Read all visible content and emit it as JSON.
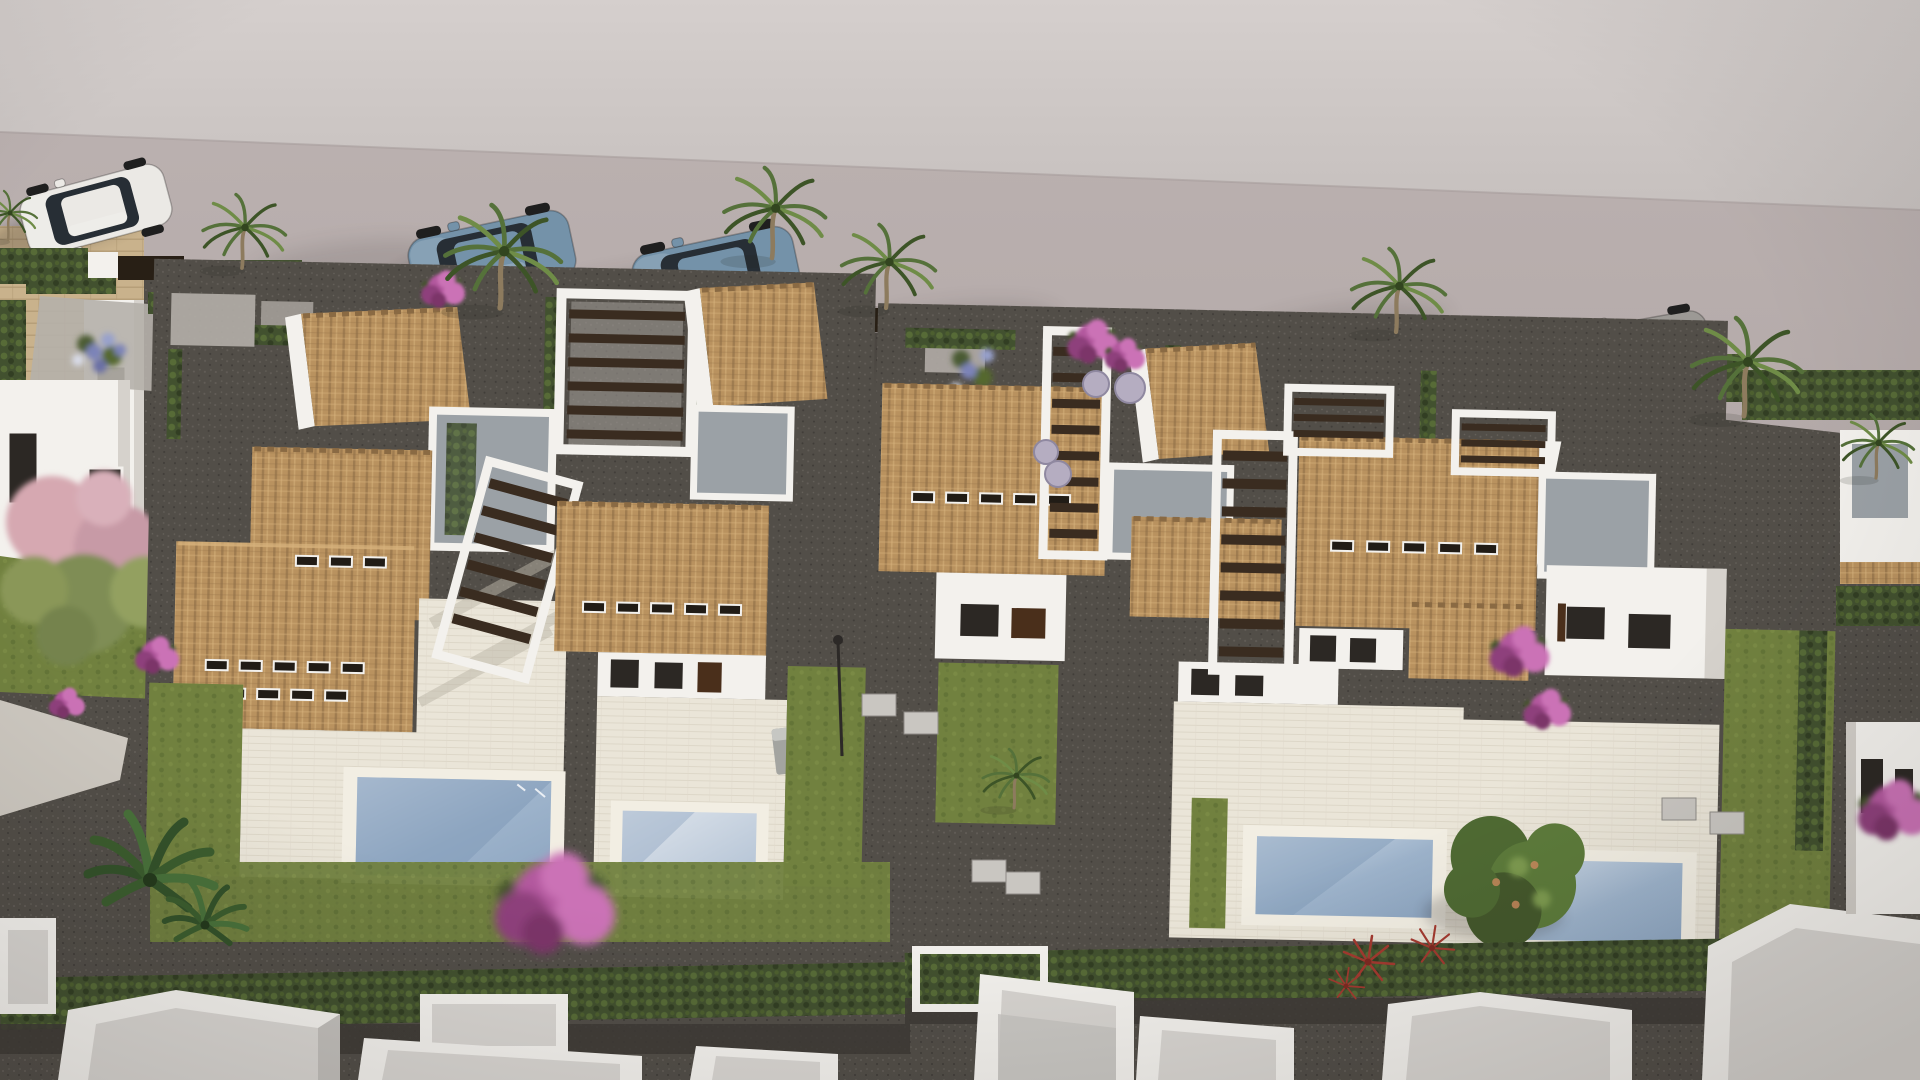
{
  "meta": {
    "kind": "3d-architectural-render",
    "view": "aerial-oblique",
    "subject": "Mediterranean villa development: two blocks of white villas with terracotta tile roofs, wood-slat pergolas, private pools and lawns, cars parked along a street above, row of unfinished white rooftops below",
    "lighting": {
      "sun_direction": "upper-right",
      "shadow_direction": "lower-left"
    }
  },
  "palette": {
    "sidewalk": "#cdc6c4",
    "sidewalk_top": "#d5cfcd",
    "road": "#b4aaa9",
    "road_dark": "#a49a99",
    "wall_white": "#f3f1ed",
    "wall_shade": "#d6d2cc",
    "roof_tile": "#b9925f",
    "roof_tile_dark": "#8a6a43",
    "roof_tile_light": "#d8b37d",
    "flat_roof": "#9ba1a6",
    "flat_roof_dark": "#84898e",
    "deck": "#eae5d8",
    "deck_shadow": "#bcb6a8",
    "pool_coping": "#f2eee3",
    "water_light": "#cdd8e5",
    "water": "#9db3cb",
    "water_dark": "#7e98b6",
    "lawn": "#71813f",
    "lawn_dark": "#5a6a32",
    "hedge": "#42512f",
    "hedge_light": "#5d7439",
    "gravel": "#524e48",
    "gravel_dark": "#3e3b36",
    "gravel_light": "#6b665f",
    "path_light": "#cdc8c0",
    "pergola_wood": "#3a2c20",
    "fence_brown": "#4a2f1b",
    "fence_dark": "#281f15",
    "car_blue": "#7492a9",
    "car_white": "#ebe9e5",
    "car_gray": "#9c9995",
    "palm_green": "#55713a",
    "palm_green_dark": "#3d5427",
    "palm_green_light": "#6f8c47",
    "palm_trunk": "#8d7b5e",
    "banana_green": "#33512a",
    "bougainvillea": "#b2589e",
    "bougainvillea_light": "#cb72b6",
    "bougainvillea_dark": "#8e3f7c",
    "blossom_pink": "#d6a8b1",
    "blossom_green": "#8a9758",
    "blue_flowers": "#7b83b8",
    "silver_bush": "#b5adc1",
    "yellow_flowers": "#c6bd5c",
    "red_plant": "#a43a30",
    "stone_wall": "#c9b28c",
    "stone_line": "#b29a74",
    "window_dark": "#2c2824",
    "shadow": "#241f1c"
  },
  "street": {
    "surface": "light pink-gray asphalt",
    "sidewalk_edge": [
      [
        0,
        132
      ],
      [
        1920,
        210
      ]
    ],
    "cars": [
      {
        "name": "white-hatchback",
        "color": "car_white",
        "x": 96,
        "y": 210,
        "rotate": 165,
        "scale": 0.95
      },
      {
        "name": "blue-suv-a",
        "color": "car_blue",
        "x": 492,
        "y": 258,
        "rotate": 168,
        "scale": 1.05
      },
      {
        "name": "blue-suv-b",
        "color": "car_blue",
        "x": 716,
        "y": 274,
        "rotate": 168,
        "scale": 1.05
      },
      {
        "name": "gray-sedan",
        "color": "car_gray",
        "x": 1636,
        "y": 352,
        "rotate": 170,
        "scale": 0.95
      }
    ]
  },
  "blocks": [
    {
      "name": "left-villa-block",
      "villas": 2,
      "pools": [
        {
          "x": 362,
          "y": 780,
          "w": 194,
          "h": 98
        },
        {
          "x": 628,
          "y": 808,
          "w": 134,
          "h": 78
        }
      ],
      "features": [
        "terracotta-hip-roofs",
        "roof-vent-slots",
        "white-pergolas-with-dark-wood-slats",
        "gray-flat-roof-terraces",
        "cream-deck-terraces",
        "private-lawns",
        "sun-lounger"
      ]
    },
    {
      "name": "right-villa-block",
      "villas": 2,
      "pools": [
        {
          "x": 1262,
          "y": 837,
          "w": 176,
          "h": 78
        },
        {
          "x": 1516,
          "y": 855,
          "w": 172,
          "h": 80
        }
      ],
      "features": [
        "terracotta-hip-roofs",
        "roof-vent-slots",
        "long-slatted-pergola-walkways",
        "gray-flat-roof-terraces",
        "cream-deck-terraces",
        "garden-tree-over-pool",
        "red-accent-plants"
      ]
    }
  ],
  "construction_row": {
    "count": 8,
    "description": "unfinished white parapet rooftops along the bottom edge"
  },
  "neighbor_left": {
    "description": "existing house with travertine stone walls, white facade, dark windows, courtyard with blue flowers and pink flowering tree"
  },
  "vegetation": {
    "palms": [
      {
        "x": 242,
        "y": 268,
        "s": 0.75
      },
      {
        "x": 500,
        "y": 308,
        "s": 1.05
      },
      {
        "x": 772,
        "y": 258,
        "s": 0.92
      },
      {
        "x": 886,
        "y": 308,
        "s": 0.85
      },
      {
        "x": 1396,
        "y": 332,
        "s": 0.85
      },
      {
        "x": 1744,
        "y": 416,
        "s": 1.0
      },
      {
        "x": 1876,
        "y": 478,
        "s": 0.65
      },
      {
        "x": 1014,
        "y": 808,
        "s": 0.6
      },
      {
        "x": 8,
        "y": 240,
        "s": 0.5
      }
    ],
    "bananas": [
      {
        "x": 150,
        "y": 880,
        "s": 1.0
      },
      {
        "x": 205,
        "y": 925,
        "s": 0.65
      }
    ],
    "bougainvillea": [
      {
        "x": 442,
        "y": 288,
        "s": 0.55
      },
      {
        "x": 1092,
        "y": 340,
        "s": 0.65
      },
      {
        "x": 1124,
        "y": 354,
        "s": 0.5
      },
      {
        "x": 552,
        "y": 900,
        "s": 1.5
      },
      {
        "x": 156,
        "y": 654,
        "s": 0.55
      },
      {
        "x": 66,
        "y": 702,
        "s": 0.45
      },
      {
        "x": 1518,
        "y": 650,
        "s": 0.75
      },
      {
        "x": 1546,
        "y": 708,
        "s": 0.6
      },
      {
        "x": 1892,
        "y": 808,
        "s": 0.9
      }
    ],
    "red_plants": [
      {
        "x": 1368,
        "y": 962,
        "s": 1.0
      },
      {
        "x": 1432,
        "y": 948,
        "s": 0.85
      },
      {
        "x": 1346,
        "y": 986,
        "s": 0.7
      }
    ],
    "silver_bushes": [
      {
        "x": 1096,
        "y": 384,
        "r": 13
      },
      {
        "x": 1130,
        "y": 388,
        "r": 15
      },
      {
        "x": 1046,
        "y": 452,
        "r": 12
      },
      {
        "x": 1058,
        "y": 474,
        "r": 13
      }
    ],
    "garden_tree": {
      "x": 1522,
      "y": 876
    }
  },
  "utilities": {
    "boxes": [
      {
        "x": 862,
        "y": 694
      },
      {
        "x": 904,
        "y": 712
      },
      {
        "x": 972,
        "y": 860
      },
      {
        "x": 1006,
        "y": 872
      },
      {
        "x": 1662,
        "y": 798
      },
      {
        "x": 1710,
        "y": 812
      }
    ],
    "lamp": {
      "x": 838,
      "y": 642
    }
  }
}
